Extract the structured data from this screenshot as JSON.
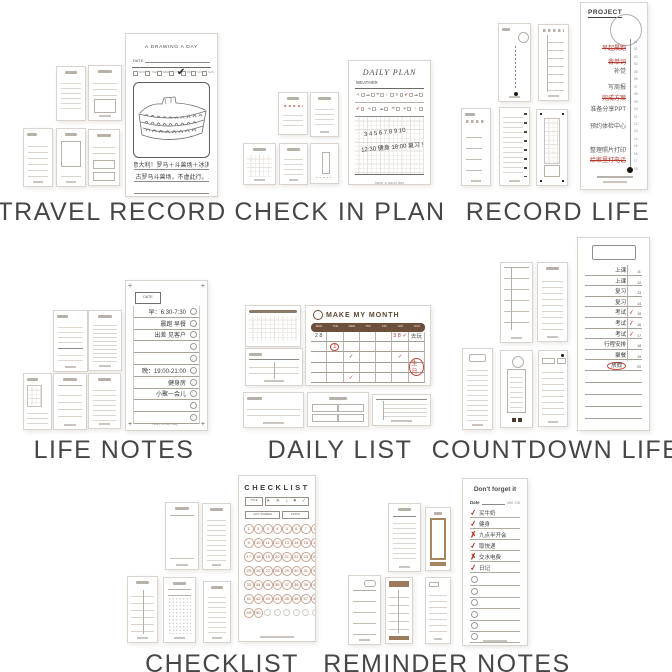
{
  "page": {
    "background": "#ffffff"
  },
  "colors": {
    "label_text": "#464646",
    "accent_red": "#b5382f",
    "brown_dark": "#6e4f39",
    "tan": "#9c7a5b",
    "card_line": "#d9d4cd",
    "ink": "#3d3d3d"
  },
  "groups": {
    "travel_record": {
      "label": "TRAVEL RECORD",
      "hero": {
        "title": "A DRAWING A DAY",
        "date_label": "DATE",
        "days": [
          "MON",
          "TUE",
          "WED",
          "THU",
          "FRI",
          "SAT",
          "SUN"
        ],
        "check_glyph": "✔",
        "note1": "去意大利！罗马＋斗兽场＋冰淇淋",
        "note2": "古罗马斗兽场，不虚此行。",
        "footer": "have a good trip"
      }
    },
    "check_in_plan": {
      "label": "CHECK IN PLAN",
      "hero": {
        "title": "DAILY PLAN",
        "weather_label": "WEATHER",
        "weather_row1": [
          {
            "g": "☀",
            "c": ""
          },
          {
            "g": "☁",
            "c": ""
          },
          {
            "g": "☂",
            "c": ""
          },
          {
            "g": "☾",
            "c": ""
          },
          {
            "g": "❄",
            "c": ""
          },
          {
            "g": "✔",
            "c": "red"
          },
          {
            "g": "☁",
            "c": ""
          }
        ],
        "weather_row2": [
          {
            "g": "✔",
            "c": "red"
          },
          {
            "g": "☀",
            "c": ""
          },
          {
            "g": "☁",
            "c": ""
          },
          {
            "g": "☂",
            "c": ""
          },
          {
            "g": "❄",
            "c": ""
          },
          {
            "g": "☾",
            "c": ""
          }
        ],
        "hand1": "3 4 5 6 7 8 9 10",
        "hand2": "12:30 健身 18:00 复习 !",
        "footer": "have a good day"
      }
    },
    "record_life": {
      "label": "RECORD LIFE",
      "hero": {
        "title": "PROJECT",
        "ticks": [
          "01",
          "02",
          "03",
          "04",
          "05",
          "06",
          "07",
          "08",
          "09",
          "10",
          "11",
          "12",
          "13",
          "14",
          "15",
          "16",
          "17",
          "18"
        ],
        "entries": [
          {
            "text": "早起晨跑",
            "top": 2,
            "cls": "done"
          },
          {
            "text": "背单词",
            "top": 16,
            "cls": "done"
          },
          {
            "text": "补觉",
            "top": 25,
            "cls": ""
          },
          {
            "text": "写周报",
            "top": 41,
            "cls": ""
          },
          {
            "text": "完成方案",
            "top": 52,
            "cls": "done"
          },
          {
            "text": "准备分享PPT",
            "top": 63,
            "cls": ""
          },
          {
            "text": "预约体检中心",
            "top": 80,
            "cls": ""
          },
          {
            "text": "整理照片打印",
            "top": 104,
            "cls": ""
          },
          {
            "text": "给家里打电话",
            "top": 114,
            "cls": "done"
          }
        ]
      }
    },
    "life_notes": {
      "label": "LIFE NOTES",
      "hero": {
        "date_label": "DATE",
        "rows": [
          {
            "text": "早：6:30-7:30"
          },
          {
            "text": "晨跑 早餐"
          },
          {
            "text": "出差 见客户"
          },
          {
            "text": ""
          },
          {
            "text": ""
          },
          {
            "text": "晚：19:00-21:00"
          },
          {
            "text": "健身房"
          },
          {
            "text": "小聚一会儿"
          },
          {
            "text": ""
          },
          {
            "text": ""
          }
        ],
        "footer": "Have a nice day ~"
      }
    },
    "daily_list": {
      "label": "DAILY LIST",
      "hero": {
        "title": "MAKE MY MONTH",
        "days": [
          "MON",
          "TUE",
          "WED",
          "THU",
          "FRI",
          "SAT",
          "SUN"
        ],
        "cells": [
          {
            "t": "2 8",
            "c": "ink"
          },
          {
            "t": "",
            "c": ""
          },
          {
            "t": "",
            "c": ""
          },
          {
            "t": "",
            "c": ""
          },
          {
            "t": "",
            "c": ""
          },
          {
            "t": "3 8 ✓",
            "c": "red"
          },
          {
            "t": "去玩",
            "c": "ink"
          },
          {
            "t": "",
            "c": ""
          },
          {
            "t": "1",
            "c": "red circ"
          },
          {
            "t": "",
            "c": ""
          },
          {
            "t": "",
            "c": ""
          },
          {
            "t": "",
            "c": ""
          },
          {
            "t": "",
            "c": ""
          },
          {
            "t": "",
            "c": ""
          },
          {
            "t": "",
            "c": ""
          },
          {
            "t": "",
            "c": ""
          },
          {
            "t": "✓",
            "c": "red"
          },
          {
            "t": "",
            "c": ""
          },
          {
            "t": "",
            "c": ""
          },
          {
            "t": "✓",
            "c": "red"
          },
          {
            "t": "",
            "c": ""
          },
          {
            "t": "",
            "c": ""
          },
          {
            "t": "",
            "c": ""
          },
          {
            "t": "",
            "c": ""
          },
          {
            "t": "",
            "c": ""
          },
          {
            "t": "",
            "c": ""
          },
          {
            "t": "",
            "c": ""
          },
          {
            "t": "生日",
            "c": "red circ"
          },
          {
            "t": "",
            "c": ""
          },
          {
            "t": "",
            "c": ""
          },
          {
            "t": "✓",
            "c": "red"
          },
          {
            "t": "",
            "c": ""
          },
          {
            "t": "",
            "c": ""
          },
          {
            "t": "",
            "c": ""
          },
          {
            "t": "",
            "c": ""
          }
        ]
      }
    },
    "countdown_life": {
      "label": "COUNTDOWN LIFE",
      "hero": {
        "rows": [
          {
            "text": "上课",
            "num": "11",
            "mk": "",
            "cls": ""
          },
          {
            "text": "上课",
            "num": "12",
            "mk": "",
            "cls": ""
          },
          {
            "text": "复习",
            "num": "13",
            "mk": "",
            "cls": ""
          },
          {
            "text": "复习",
            "num": "14",
            "mk": "",
            "cls": ""
          },
          {
            "text": "考试",
            "num": "15",
            "mk": "✓",
            "cls": ""
          },
          {
            "text": "考试",
            "num": "16",
            "mk": "✓",
            "cls": ""
          },
          {
            "text": "考试",
            "num": "17",
            "mk": "✓",
            "cls": ""
          },
          {
            "text": "行程安排",
            "num": "18",
            "mk": "",
            "cls": ""
          },
          {
            "text": "聚餐",
            "num": "19",
            "mk": "",
            "cls": ""
          },
          {
            "text": "放假",
            "num": "20",
            "mk": "",
            "cls": "circled"
          }
        ]
      }
    },
    "checklist": {
      "label": "CHECKLIST",
      "hero": {
        "title": "CHECKLIST",
        "title_label": "TITLE",
        "icons": "✈ ☀ ♪ ♥ ✓",
        "last_number_label": "LAST NUMBER",
        "finish_label": "FINISH",
        "cells": [
          "1",
          "2",
          "3",
          "4",
          "5",
          "6",
          "7",
          "8",
          "9",
          "10",
          "11",
          "12",
          "13",
          "14",
          "15",
          "16",
          "17",
          "18",
          "19",
          "20",
          "21",
          "22",
          "23",
          "24",
          "25",
          "26",
          "27",
          "28",
          "29",
          "30",
          "31",
          "32",
          "33",
          "34",
          "35",
          "36",
          "37",
          "38",
          "39",
          "40",
          "41",
          "42",
          "43",
          "44",
          "45",
          "46",
          "47",
          "48",
          "49",
          "50",
          "",
          "",
          "",
          "",
          "",
          ""
        ]
      }
    },
    "reminder_notes": {
      "label": "REMINDER NOTES",
      "hero": {
        "title": "Don't forget it",
        "date_label": "Date",
        "date_right": "MM / DD",
        "rows": [
          {
            "mk": "✓",
            "text": "买牛奶"
          },
          {
            "mk": "✓",
            "text": "健身"
          },
          {
            "mk": "✗",
            "text": "九点半开会"
          },
          {
            "mk": "✓",
            "text": "取快递"
          },
          {
            "mk": "✗",
            "text": "交水电费"
          },
          {
            "mk": "✓",
            "text": "日记"
          }
        ]
      }
    }
  }
}
